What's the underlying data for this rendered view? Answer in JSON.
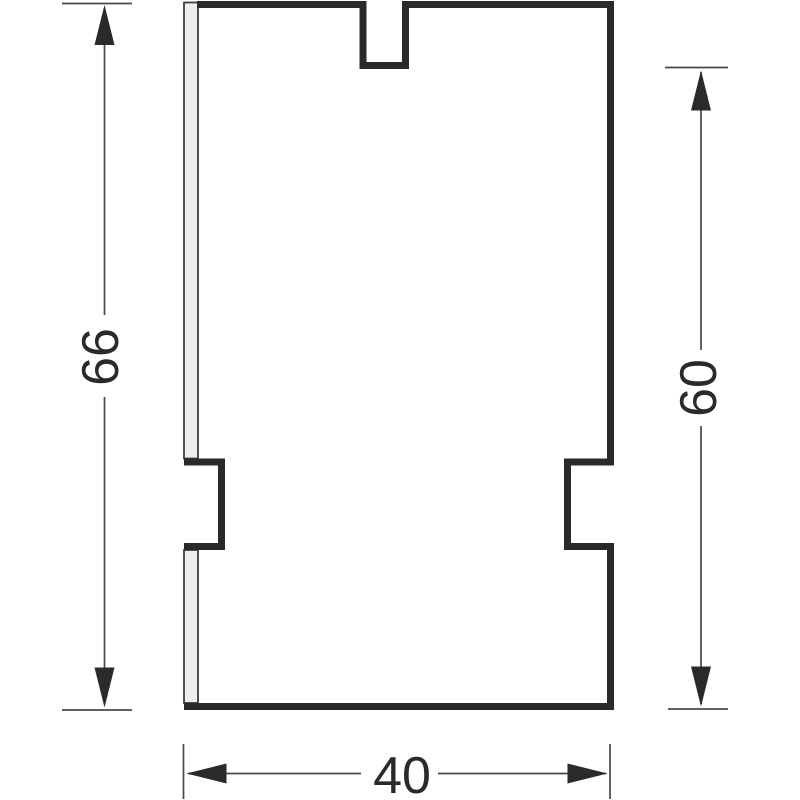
{
  "drawing": {
    "kind": "technical-cross-section-profile",
    "dimensions": {
      "total_height": {
        "label": "66",
        "orientation": "vertical",
        "position": "left"
      },
      "partial_height": {
        "label": "60",
        "orientation": "vertical",
        "position": "right"
      },
      "width": {
        "label": "40",
        "orientation": "horizontal",
        "position": "bottom"
      }
    },
    "colors": {
      "background": "#ffffff",
      "part_outline": "#2b2a29",
      "dimension_lines": "#4a4948",
      "dimension_text": "#2b2a29",
      "glazing_strip_fill": "#ecefee",
      "glazing_strip_outline": "#3d3d3c"
    }
  }
}
